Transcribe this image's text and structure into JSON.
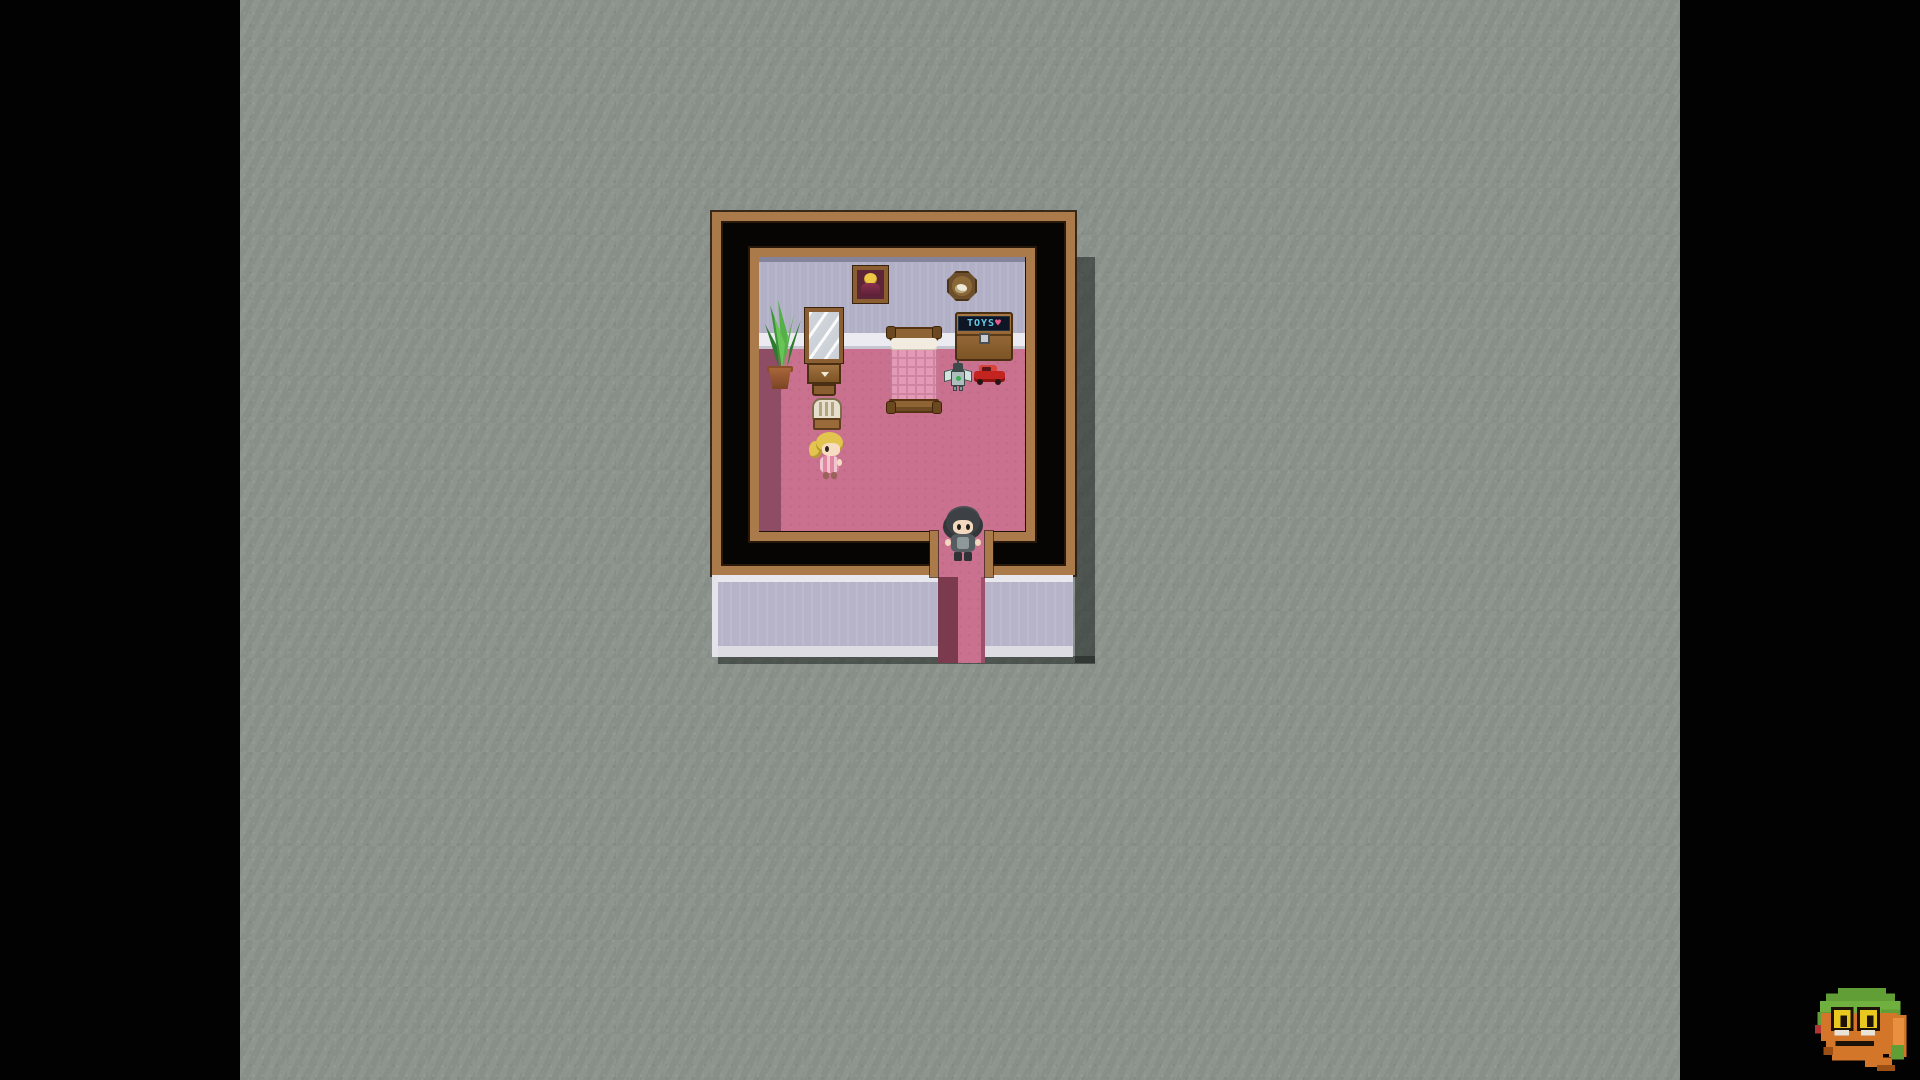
{
  "window": {
    "type": "game-screenshot",
    "letterbox": "black side bars"
  },
  "game": {
    "style": "top-down RPG room (RPG Maker style), child bedroom",
    "room": {
      "toybox_label": "TOYS",
      "toybox_heart": "♥",
      "objects": [
        "wall portrait",
        "wall clock",
        "mirror vanity with cabinet and stool",
        "potted plant",
        "pink quilted bed",
        "toy chest labeled TOYS",
        "robot toy",
        "red toy car",
        "wooden chair"
      ],
      "characters": [
        {
          "name": "girl",
          "hair": "blonde ponytail",
          "outfit": "pink striped dress",
          "position": "left side of room, below chair"
        },
        {
          "name": "boy",
          "hair": "dark messy",
          "outfit": "gray shirt, dark pants",
          "position": "standing in doorway at bottom"
        }
      ]
    },
    "colors": {
      "background": "#8b928c",
      "letterbox": "#020202",
      "floor_pink": "#c9718e",
      "floor_shadow": "#8e4c65",
      "wall_lavender": "#b2b0c6",
      "frame_wood": "#aa7a4b",
      "door_shadow": "#7b3a4e",
      "outer_wall_band": "#b7b4ca",
      "toybox_text": "#66c8e6"
    }
  },
  "logo": {
    "name": "pixel toad mascot",
    "colors": {
      "green": "#619f36",
      "orange": "#d4762a",
      "yellow": "#e9c91f"
    }
  }
}
